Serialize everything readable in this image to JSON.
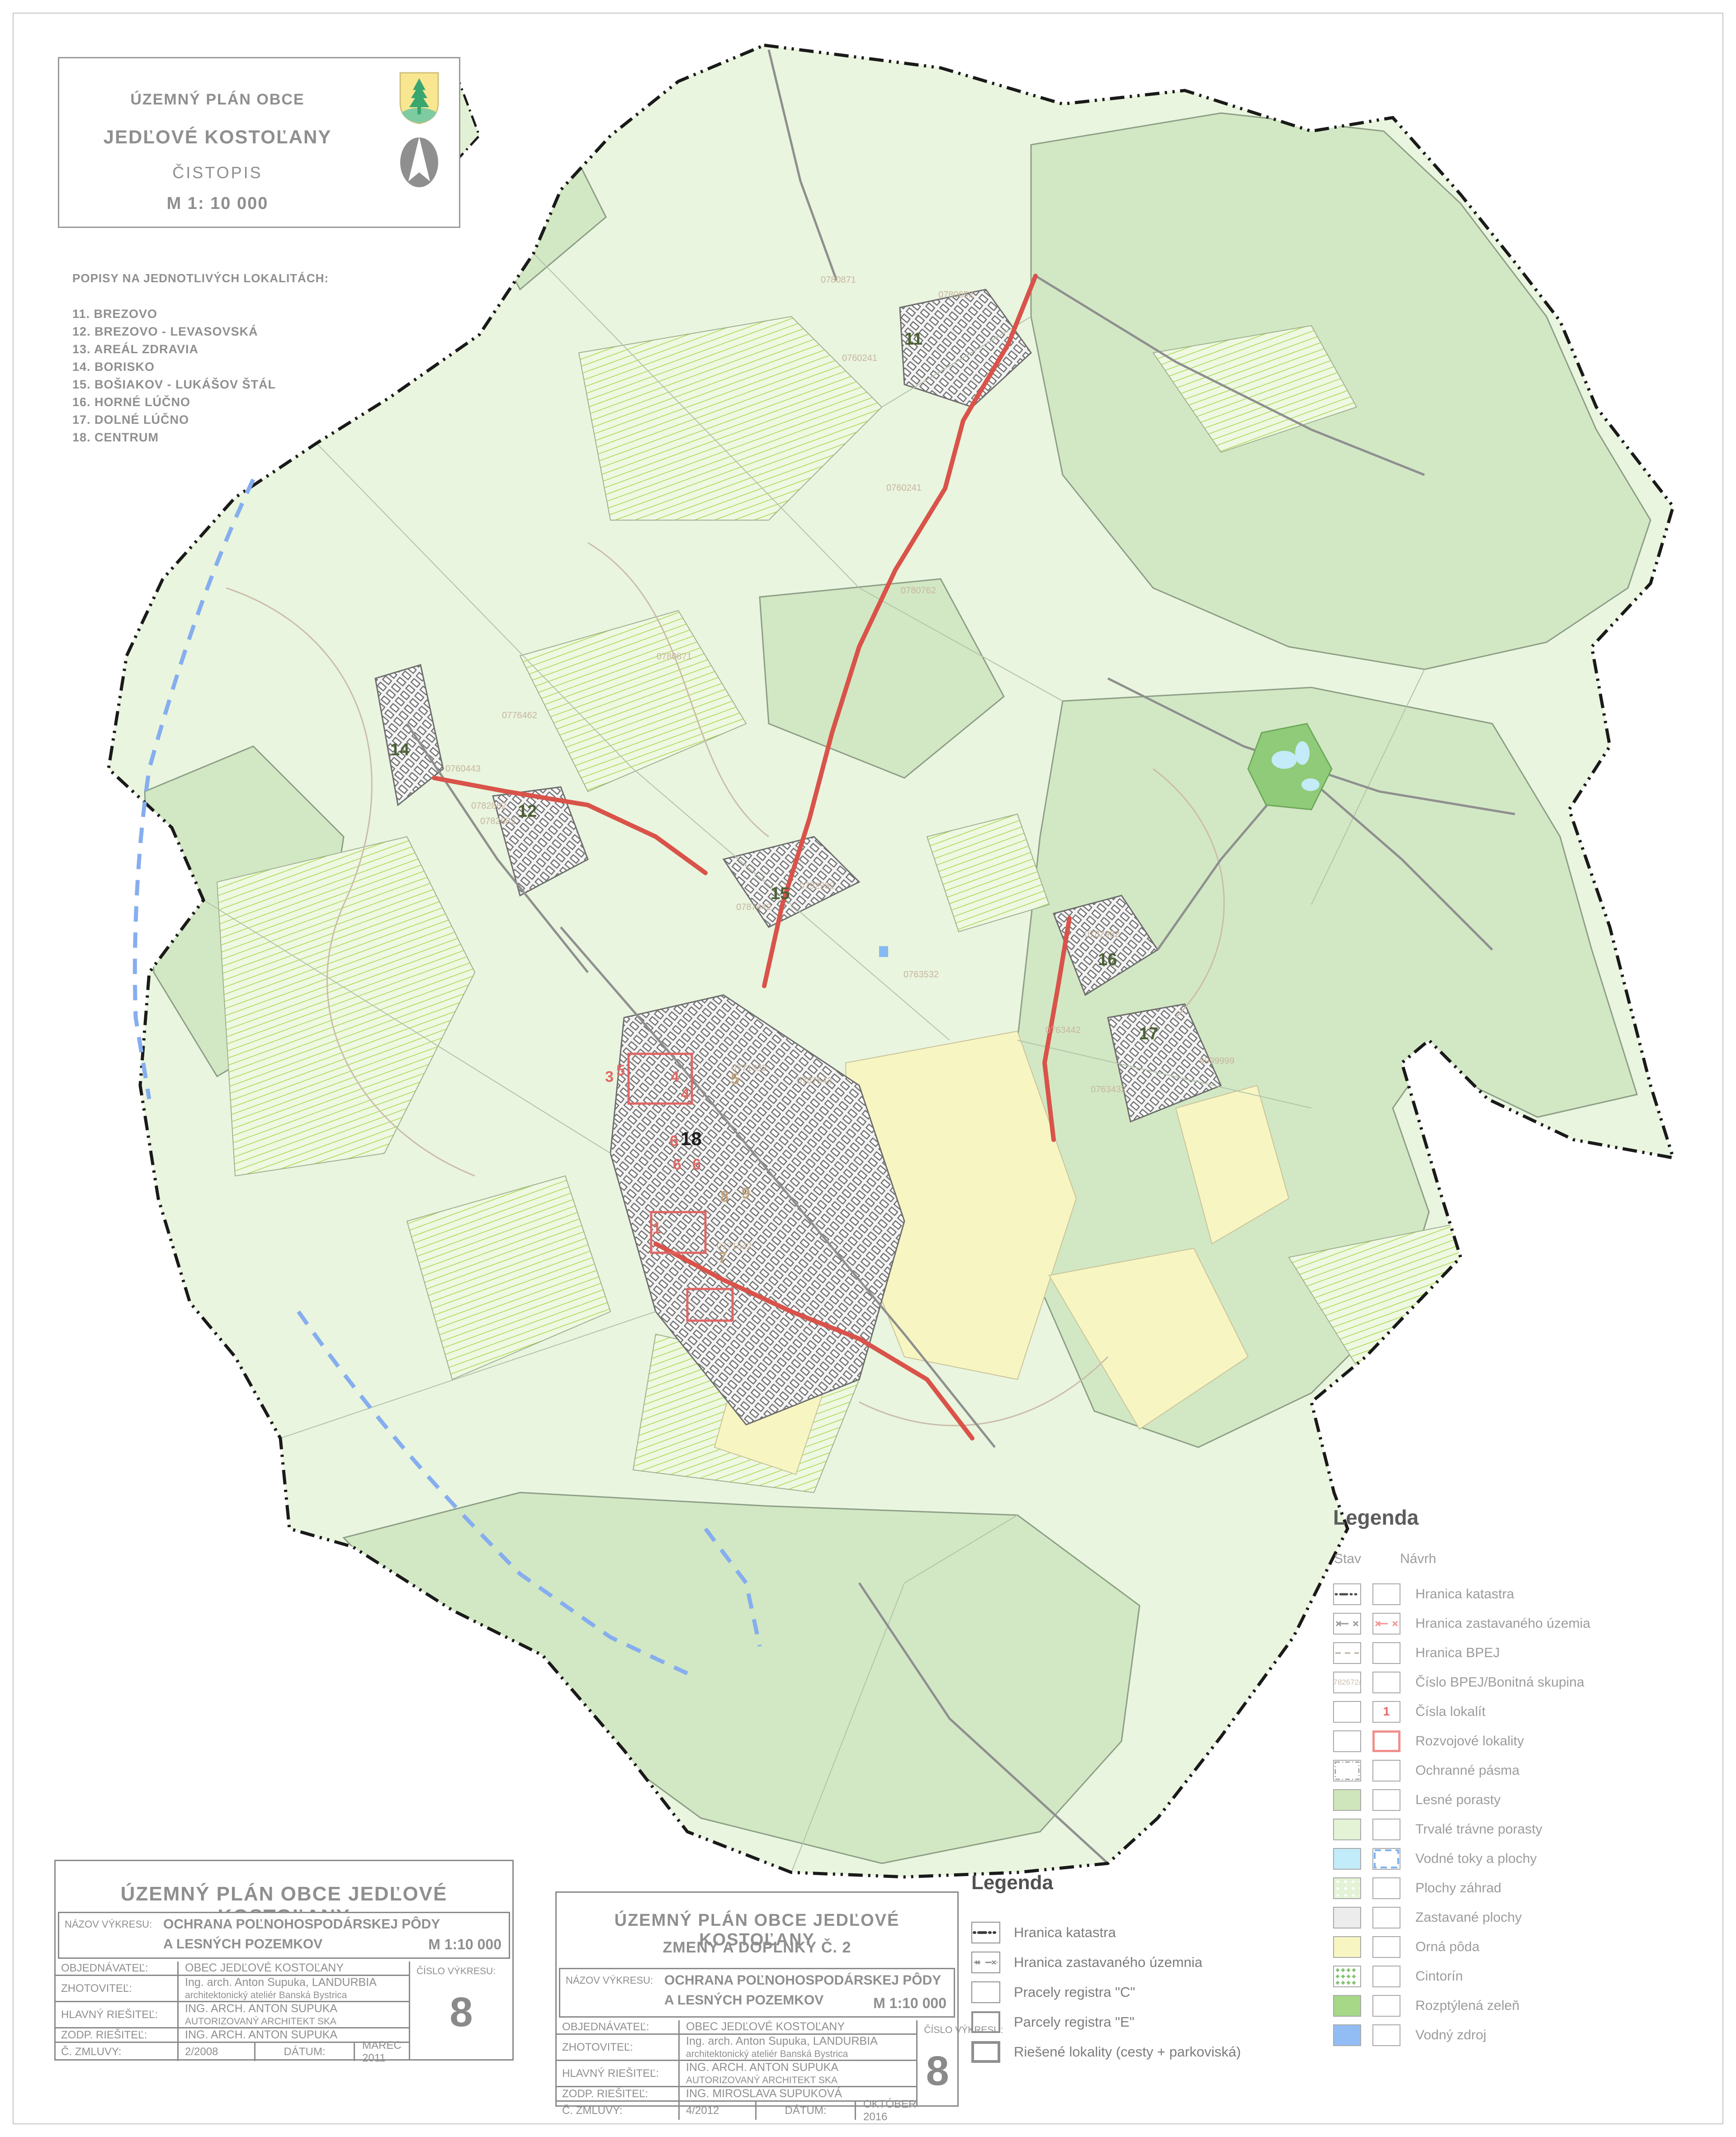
{
  "title_block": {
    "line1": "ÚZEMNÝ PLÁN OBCE",
    "line2": "JEDĽOVÉ KOSTOĽANY",
    "line3": "ČISTOPIS",
    "line4": "M 1: 10 000"
  },
  "popisy": {
    "heading": "POPISY NA JEDNOTLIVÝCH LOKALITÁCH:",
    "items": [
      "11. BREZOVO",
      "12. BREZOVO - LEVASOVSKÁ",
      "13. AREÁL ZDRAVIA",
      "14. BORISKO",
      "15. BOŠIAKOV - LUKÁŠOV ŠTÁL",
      "16. HORNÉ LÚČNO",
      "17. DOLNÉ LÚČNO",
      "18. CENTRUM"
    ]
  },
  "legend_right": {
    "title": "Legenda",
    "col_stav": "Stav",
    "col_navrh": "Návrh",
    "rows": [
      {
        "label": "Hranica katastra"
      },
      {
        "label": "Hranica zastavaného územia"
      },
      {
        "label": "Hranica BPEJ"
      },
      {
        "label": "Číslo BPEJ/Bonitná skupina",
        "sample": "0782672/9"
      },
      {
        "label": "Čísla lokalít",
        "sample": "1"
      },
      {
        "label": "Rozvojové lokality"
      },
      {
        "label": "Ochranné pásma"
      },
      {
        "label": "Lesné porasty"
      },
      {
        "label": "Trvalé trávne porasty"
      },
      {
        "label": "Vodné toky a plochy"
      },
      {
        "label": "Plochy záhrad"
      },
      {
        "label": "Zastavané plochy"
      },
      {
        "label": "Orná pôda"
      },
      {
        "label": "Cintorín"
      },
      {
        "label": "Rozptýlená zeleň"
      },
      {
        "label": "Vodný zdroj"
      }
    ]
  },
  "legend_bottom": {
    "title": "Legenda",
    "rows": [
      {
        "label": "Hranica katastra"
      },
      {
        "label": "Hranica zastavaného územnia"
      },
      {
        "label": "Pracely registra \"C\""
      },
      {
        "label": "Parcely registra \"E\""
      },
      {
        "label": "Riešené lokality (cesty + parkoviská)"
      }
    ]
  },
  "tb_left": {
    "title": "ÚZEMNÝ PLÁN OBCE JEDĽOVÉ KOSTOĽANY",
    "nazov_label": "NÁZOV VÝKRESU:",
    "nazov_line1": "OCHRANA POĽNOHOSPODÁRSKEJ PÔDY",
    "nazov_line2": "A LESNÝCH POZEMKOV",
    "scale": "M 1:10 000",
    "r1_label": "OBJEDNÁVATEĽ:",
    "r1_value": "OBEC JEDĽOVÉ KOSTOĽANY",
    "r2_label": "ZHOTOVITEĽ:",
    "r2_value1": "Ing. arch. Anton Supuka,  LANDURBIA",
    "r2_value2": "architektonický ateliér Banská Bystrica",
    "r3_label": "HLAVNÝ RIEŠITEĽ:",
    "r3_value1": "ING. ARCH. ANTON SUPUKA",
    "r3_value2": "AUTORIZOVANÝ   ARCHITEKT   SKA",
    "r4_label": "ZODP. RIEŠITEĽ:",
    "r4_value": "ING. ARCH. ANTON SUPUKA",
    "cislo_label": "ČÍSLO VÝKRESU:",
    "cislo_value": "8",
    "zml_label": "Č. ZMLUVY:",
    "zml_value": "2/2008",
    "datum_label": "DÁTUM:",
    "datum_value": "MAREC 2011"
  },
  "tb_mid": {
    "title": "ÚZEMNÝ PLÁN OBCE JEDĽOVÉ KOSTOĽANY",
    "title2": "ZMENY A DOPLNKY Č. 2",
    "nazov_label": "NÁZOV VÝKRESU:",
    "nazov_line1": "OCHRANA POĽNOHOSPODÁRSKEJ PÔDY",
    "nazov_line2": "A LESNÝCH POZEMKOV",
    "scale": "M 1:10 000",
    "r1_label": "OBJEDNÁVATEĽ:",
    "r1_value": "OBEC JEDĽOVÉ KOSTOĽANY",
    "r2_label": "ZHOTOVITEĽ:",
    "r2_value1": "Ing. arch. Anton Supuka,  LANDURBIA",
    "r2_value2": "architektonický ateliér Banská Bystrica",
    "r3_label": "HLAVNÝ RIEŠITEĽ:",
    "r3_value1": "ING. ARCH. ANTON SUPUKA",
    "r3_value2": "AUTORIZOVANÝ   ARCHITEKT   SKA",
    "r4_label": "ZODP. RIEŠITEĽ:",
    "r4_value": "ING. MIROSLAVA SUPUKOVÁ",
    "cislo_label": "ČÍSLO VÝKRESU:",
    "cislo_value": "8",
    "zml_label": "Č. ZMLUVY:",
    "zml_value": "4/2012",
    "datum_label": "DÁTUM:",
    "datum_value": "OKTÓBER  2016"
  },
  "map": {
    "loc_numbers": [
      {
        "n": "11"
      },
      {
        "n": "12"
      },
      {
        "n": "14"
      },
      {
        "n": "15"
      },
      {
        "n": "16"
      },
      {
        "n": "17"
      }
    ],
    "centrum_number": "18",
    "red_numbers": [
      {
        "n": "3"
      },
      {
        "n": "4"
      },
      {
        "n": "4"
      },
      {
        "n": "5"
      },
      {
        "n": "6"
      },
      {
        "n": "6"
      },
      {
        "n": "6"
      },
      {
        "n": "1"
      }
    ],
    "tan_numbers": [
      {
        "n": "5"
      },
      {
        "n": "7"
      },
      {
        "n": "8"
      },
      {
        "n": "9"
      }
    ],
    "bpej": [
      {
        "t": "0780871"
      },
      {
        "t": "0780652"
      },
      {
        "t": "0760241"
      },
      {
        "t": "0760241"
      },
      {
        "t": "0780762"
      },
      {
        "t": "0780871"
      },
      {
        "t": "0776462"
      },
      {
        "t": "0760443"
      },
      {
        "t": "0782882"
      },
      {
        "t": "0782682"
      },
      {
        "t": "0787442"
      },
      {
        "t": "0792982"
      },
      {
        "t": "0782982"
      },
      {
        "t": "0763442"
      },
      {
        "t": "9999999"
      },
      {
        "t": "0763432"
      },
      {
        "t": "0763532"
      },
      {
        "t": "0771332"
      },
      {
        "t": "0787542"
      },
      {
        "t": "0771542"
      }
    ],
    "colors": {
      "forest_green": "#d2e8c4",
      "meadow_green": "#e9f5de",
      "stripe_green": "#a6d746",
      "orna_yellow": "#f7f5c2",
      "water_blue": "#c2ecf9",
      "water_source_blue": "#92bdf4",
      "scattered_green": "#a6d887",
      "built_gray": "#ececec",
      "development_red": "#d9534a",
      "stream_blue": "#86aeef",
      "bpej_tan": "#c7b5a0",
      "boundary_black": "#1a1a1a"
    }
  }
}
